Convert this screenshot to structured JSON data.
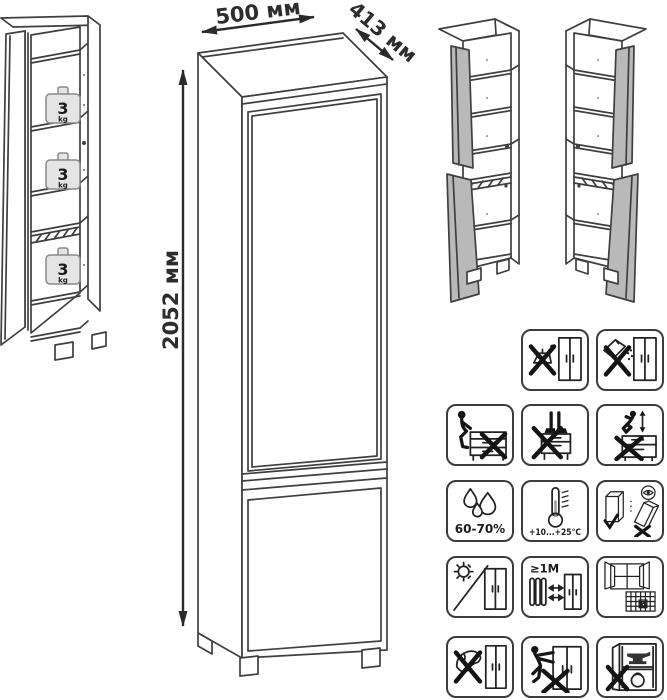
{
  "sheet": {
    "type": "furniture-assembly-diagram",
    "colors": {
      "line": "#3f3f3f",
      "door_shade": "#b9b9b9",
      "weight_fill": "#e4e4e4",
      "icon_line": "#1e1e1e"
    }
  },
  "drawing": {
    "dimensions": {
      "width": "500 мм",
      "depth": "413 мм",
      "height": "2052 мм"
    },
    "shelf_load": {
      "value": "3",
      "unit": "kg"
    }
  },
  "icon_grid": {
    "rows": [
      [
        {
          "name": "no-aggressive-liquids"
        },
        {
          "name": "no-abrasive-powders"
        }
      ],
      [
        {
          "name": "no-sitting"
        },
        {
          "name": "no-standing"
        },
        {
          "name": "no-jumping"
        }
      ],
      [
        {
          "name": "humidity-range",
          "label": "60-70%"
        },
        {
          "name": "temperature-range",
          "label": "+10...+25°C"
        },
        {
          "name": "transport-upright"
        }
      ],
      [
        {
          "name": "no-direct-sunlight"
        },
        {
          "name": "heat-source-distance",
          "label": "≥1M"
        },
        {
          "name": "ventilate-room",
          "calendar_day": "21"
        }
      ],
      [
        {
          "name": "no-harsh-cleaning"
        },
        {
          "name": "no-dragging"
        },
        {
          "name": "no-overloading"
        }
      ]
    ]
  }
}
